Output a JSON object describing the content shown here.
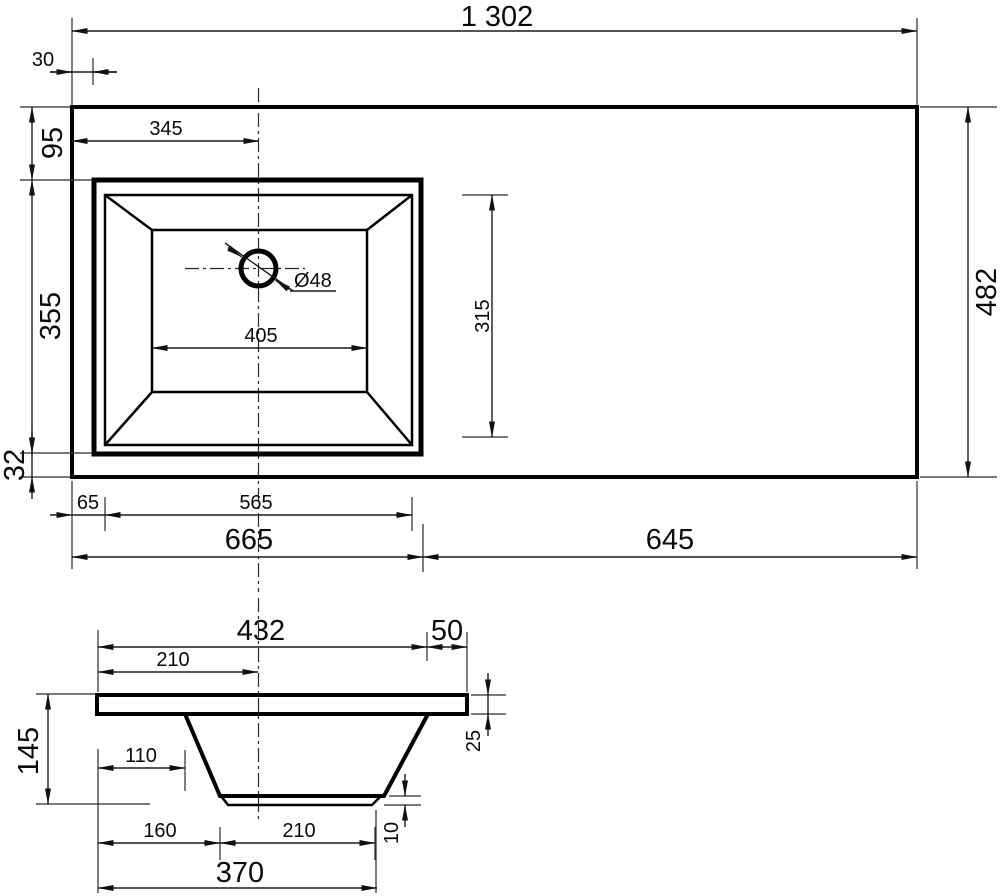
{
  "dims": {
    "overall_width": "1 302",
    "edge_offset": "30",
    "front_to_basin": "95",
    "basin_depth": "355",
    "basin_to_edge": "32",
    "center_from_left": "345",
    "drain_diameter": "Ø48",
    "basin_floor_width": "405",
    "basin_inner_depth": "315",
    "rim_offset": "65",
    "basin_outer_width": "565",
    "left_section": "665",
    "right_section": "645",
    "overall_depth": "482",
    "section": {
      "top_width": "432",
      "overhang": "50",
      "center_offset": "210",
      "slab_thickness": "25",
      "wall_offset": "110",
      "height": "145",
      "bottom_inset": "160",
      "bottom_width": "210",
      "lip_height": "10",
      "bottom_span": "370"
    }
  }
}
